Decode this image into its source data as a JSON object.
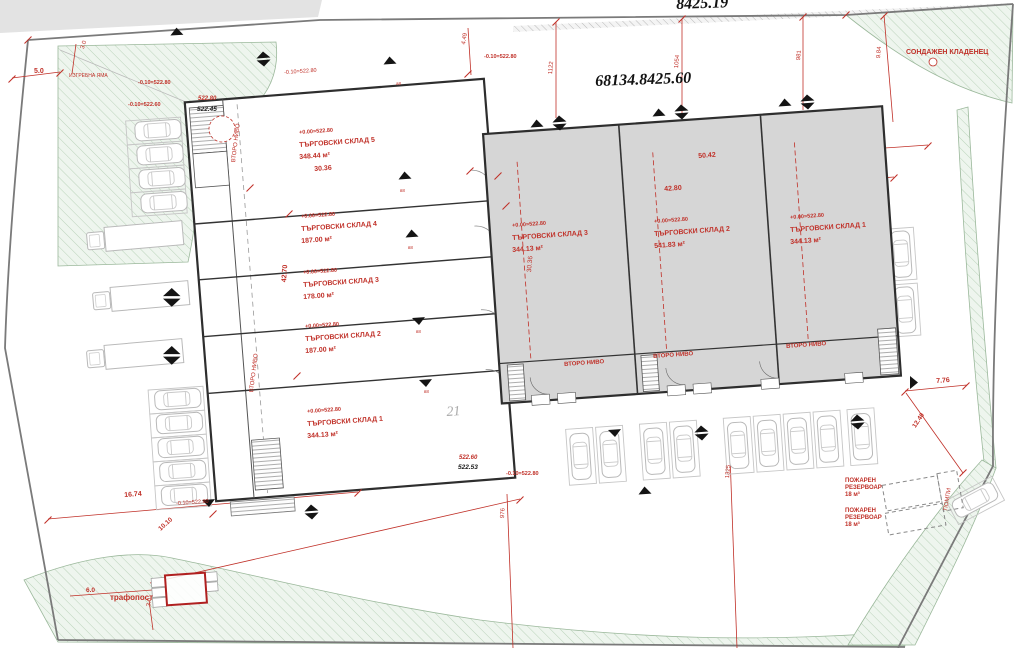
{
  "titles": {
    "plan_number_top": "8425.19",
    "cadastral_number": "68134.8425.60",
    "plot_label": "21"
  },
  "colors": {
    "annotation_red": "#c03028",
    "building_gray": "#d6d6d6",
    "green_area": "#eef5ee",
    "line_dark": "#2e2e2e"
  },
  "left_building": {
    "units": [
      {
        "name": "ТЪРГОВСКИ СКЛАД 5",
        "area": "348.44 м²",
        "elevation": "+0.00=522.80",
        "x": 299,
        "y": 131,
        "rot": -4
      },
      {
        "name": "ТЪРГОВСКИ СКЛАД 4",
        "area": "187.00 м²",
        "elevation": "+0.00=522.80",
        "x": 301,
        "y": 215,
        "rot": -4
      },
      {
        "name": "ТЪРГОВСКИ СКЛАД 3",
        "area": "178.00 м²",
        "elevation": "+0.00=522.80",
        "x": 303,
        "y": 271,
        "rot": -4
      },
      {
        "name": "ТЪРГОВСКИ СКЛАД 2",
        "area": "187.00 м²",
        "elevation": "+0.00=522.80",
        "x": 305,
        "y": 325,
        "rot": -4
      },
      {
        "name": "ТЪРГОВСКИ СКЛАД 1",
        "area": "344.13 м²",
        "elevation": "+0.00=522.80",
        "x": 307,
        "y": 410,
        "rot": -4
      }
    ]
  },
  "right_building": {
    "units": [
      {
        "name": "ТЪРГОВСКИ СКЛАД 3",
        "area": "344.13 м²",
        "elevation": "+0.00=522.80",
        "x": 512,
        "y": 224,
        "rot": -4
      },
      {
        "name": "ТЪРГОВСКИ СКЛАД 2",
        "area": "541.83 м²",
        "elevation": "+0.00=522.80",
        "x": 654,
        "y": 220,
        "rot": -4
      },
      {
        "name": "ТЪРГОВСКИ СКЛАД 1",
        "area": "344.13 м²",
        "elevation": "+0.00=522.80",
        "x": 790,
        "y": 216,
        "rot": -4
      }
    ]
  },
  "labels": [
    {
      "t": "СОНДАЖЕН КЛАДЕНЕЦ",
      "x": 906,
      "y": 49,
      "fs": 7,
      "b": 1,
      "n": "label-borehole-well"
    },
    {
      "t": "ИЗГРЕБНА ЯМА",
      "x": 69,
      "y": 74,
      "fs": 5,
      "n": "label-cesspool"
    },
    {
      "t": "5.0",
      "x": 34,
      "y": 68,
      "fs": 7,
      "b": 1,
      "n": "dimension-label"
    },
    {
      "t": "3.0",
      "x": 80,
      "y": 48,
      "fs": 6,
      "rot": -72,
      "n": "dimension-label"
    },
    {
      "t": "-0.10=522.80",
      "x": 138,
      "y": 81,
      "fs": 5.5,
      "b": 1,
      "n": "elevation-label"
    },
    {
      "t": "-0.10=522.60",
      "x": 128,
      "y": 103,
      "fs": 5.5,
      "b": 1,
      "n": "elevation-label"
    },
    {
      "t": "522.80",
      "x": 198,
      "y": 96,
      "fs": 6,
      "b": 1,
      "i": 1,
      "n": "elevation-label"
    },
    {
      "t": "522.45",
      "x": 197,
      "y": 107,
      "fs": 6.5,
      "b": 1,
      "i": 1,
      "c": "k",
      "n": "elevation-label"
    },
    {
      "t": "-0.10=522.80",
      "x": 284,
      "y": 71,
      "fs": 5.5,
      "rot": -4,
      "n": "elevation-label"
    },
    {
      "t": "4.49",
      "x": 461,
      "y": 44,
      "fs": 6,
      "rot": -80,
      "n": "dimension-label"
    },
    {
      "t": "-0.10=522.80",
      "x": 484,
      "y": 55,
      "fs": 5.5,
      "b": 1,
      "n": "elevation-label"
    },
    {
      "t": "1122",
      "x": 548,
      "y": 74,
      "fs": 6,
      "rot": -85,
      "n": "boundary-length-label"
    },
    {
      "t": "1054",
      "x": 674,
      "y": 68,
      "fs": 6,
      "rot": -85,
      "n": "boundary-length-label"
    },
    {
      "t": "981",
      "x": 796,
      "y": 60,
      "fs": 6,
      "rot": -85,
      "n": "boundary-length-label"
    },
    {
      "t": "9.84",
      "x": 876,
      "y": 58,
      "fs": 6,
      "rot": -85,
      "n": "dimension-label"
    },
    {
      "t": "50.42",
      "x": 698,
      "y": 153,
      "fs": 7,
      "b": 1,
      "rot": -4,
      "n": "dimension-label"
    },
    {
      "t": "42.80",
      "x": 664,
      "y": 186,
      "fs": 7,
      "b": 1,
      "rot": -4,
      "n": "dimension-label"
    },
    {
      "t": "30.36",
      "x": 314,
      "y": 166,
      "fs": 7,
      "b": 1,
      "rot": -4,
      "n": "dimension-label"
    },
    {
      "t": "42.70",
      "x": 281,
      "y": 282,
      "fs": 7,
      "b": 1,
      "rot": -86,
      "n": "dimension-label"
    },
    {
      "t": "30.36",
      "x": 527,
      "y": 272,
      "fs": 6.5,
      "rot": -85,
      "n": "dimension-label"
    },
    {
      "t": "ВТОРО НИВО",
      "x": 231,
      "y": 162,
      "fs": 6,
      "rot": -83,
      "n": "second-level-label"
    },
    {
      "t": "ВТОРО НИВО",
      "x": 249,
      "y": 392,
      "fs": 6,
      "rot": -83,
      "n": "second-level-label"
    },
    {
      "t": "ВТОРО НИВО",
      "x": 564,
      "y": 362,
      "fs": 6,
      "b": 1,
      "rot": -4,
      "n": "second-level-label"
    },
    {
      "t": "ВТОРО НИВО",
      "x": 653,
      "y": 354,
      "fs": 6,
      "b": 1,
      "rot": -4,
      "n": "second-level-label"
    },
    {
      "t": "ВТОРО НИВО",
      "x": 786,
      "y": 344,
      "fs": 6,
      "b": 1,
      "rot": -4,
      "n": "second-level-label"
    },
    {
      "t": "522.60",
      "x": 459,
      "y": 455,
      "fs": 6,
      "b": 1,
      "i": 1,
      "n": "elevation-label"
    },
    {
      "t": "522.53",
      "x": 458,
      "y": 465,
      "fs": 6.5,
      "b": 1,
      "i": 1,
      "c": "k",
      "n": "elevation-label"
    },
    {
      "t": "-0.10=522.80",
      "x": 506,
      "y": 472,
      "fs": 5.5,
      "b": 1,
      "n": "elevation-label"
    },
    {
      "t": "976",
      "x": 500,
      "y": 518,
      "fs": 6,
      "rot": -87,
      "n": "boundary-length-label"
    },
    {
      "t": "-0.10=522.80",
      "x": 176,
      "y": 502,
      "fs": 5.5,
      "rot": -4,
      "n": "elevation-label"
    },
    {
      "t": "16.74",
      "x": 124,
      "y": 492,
      "fs": 7,
      "b": 1,
      "rot": -4,
      "n": "dimension-label"
    },
    {
      "t": "10.10",
      "x": 158,
      "y": 528,
      "fs": 6.5,
      "b": 1,
      "rot": -42,
      "n": "dimension-label"
    },
    {
      "t": "1325",
      "x": 725,
      "y": 478,
      "fs": 6,
      "rot": -85,
      "n": "boundary-length-label"
    },
    {
      "t": "7.76",
      "x": 936,
      "y": 378,
      "fs": 7,
      "b": 1,
      "rot": -4,
      "n": "dimension-label"
    },
    {
      "t": "12.40",
      "x": 912,
      "y": 426,
      "fs": 6.5,
      "b": 1,
      "rot": -56,
      "n": "dimension-label"
    },
    {
      "t": "ПОЖАРЕН",
      "x": 845,
      "y": 478,
      "fs": 6,
      "b": 1,
      "n": "label-fire-reservoir"
    },
    {
      "t": "РЕЗЕРВОАР",
      "x": 845,
      "y": 485,
      "fs": 6,
      "b": 1,
      "n": "label-fire-reservoir"
    },
    {
      "t": "18 м³",
      "x": 845,
      "y": 492,
      "fs": 6,
      "b": 1,
      "n": "label-fire-reservoir"
    },
    {
      "t": "ПОЖАРЕН",
      "x": 845,
      "y": 508,
      "fs": 6,
      "b": 1,
      "n": "label-fire-reservoir"
    },
    {
      "t": "РЕЗЕРВОАР",
      "x": 845,
      "y": 515,
      "fs": 6,
      "b": 1,
      "n": "label-fire-reservoir"
    },
    {
      "t": "18 м³",
      "x": 845,
      "y": 522,
      "fs": 6,
      "b": 1,
      "n": "label-fire-reservoir"
    },
    {
      "t": "ПОМПИ",
      "x": 943,
      "y": 510,
      "fs": 6,
      "rot": -80,
      "n": "label-pumps"
    },
    {
      "t": "трафопост",
      "x": 110,
      "y": 594,
      "fs": 8,
      "b": 1,
      "n": "label-transformer-station"
    },
    {
      "t": "6.0",
      "x": 86,
      "y": 588,
      "fs": 6.5,
      "b": 1,
      "n": "dimension-label"
    },
    {
      "t": "3.0",
      "x": 146,
      "y": 606,
      "fs": 6,
      "rot": -80,
      "n": "dimension-label"
    },
    {
      "t": "а8",
      "x": 396,
      "y": 82,
      "fs": 4.5,
      "n": "door-tag"
    },
    {
      "t": "в8",
      "x": 400,
      "y": 189,
      "fs": 4.5,
      "n": "door-tag"
    },
    {
      "t": "в8",
      "x": 408,
      "y": 246,
      "fs": 4.5,
      "n": "door-tag"
    },
    {
      "t": "в8",
      "x": 416,
      "y": 330,
      "fs": 4.5,
      "n": "door-tag"
    },
    {
      "t": "в8",
      "x": 424,
      "y": 390,
      "fs": 4.5,
      "n": "door-tag"
    }
  ]
}
